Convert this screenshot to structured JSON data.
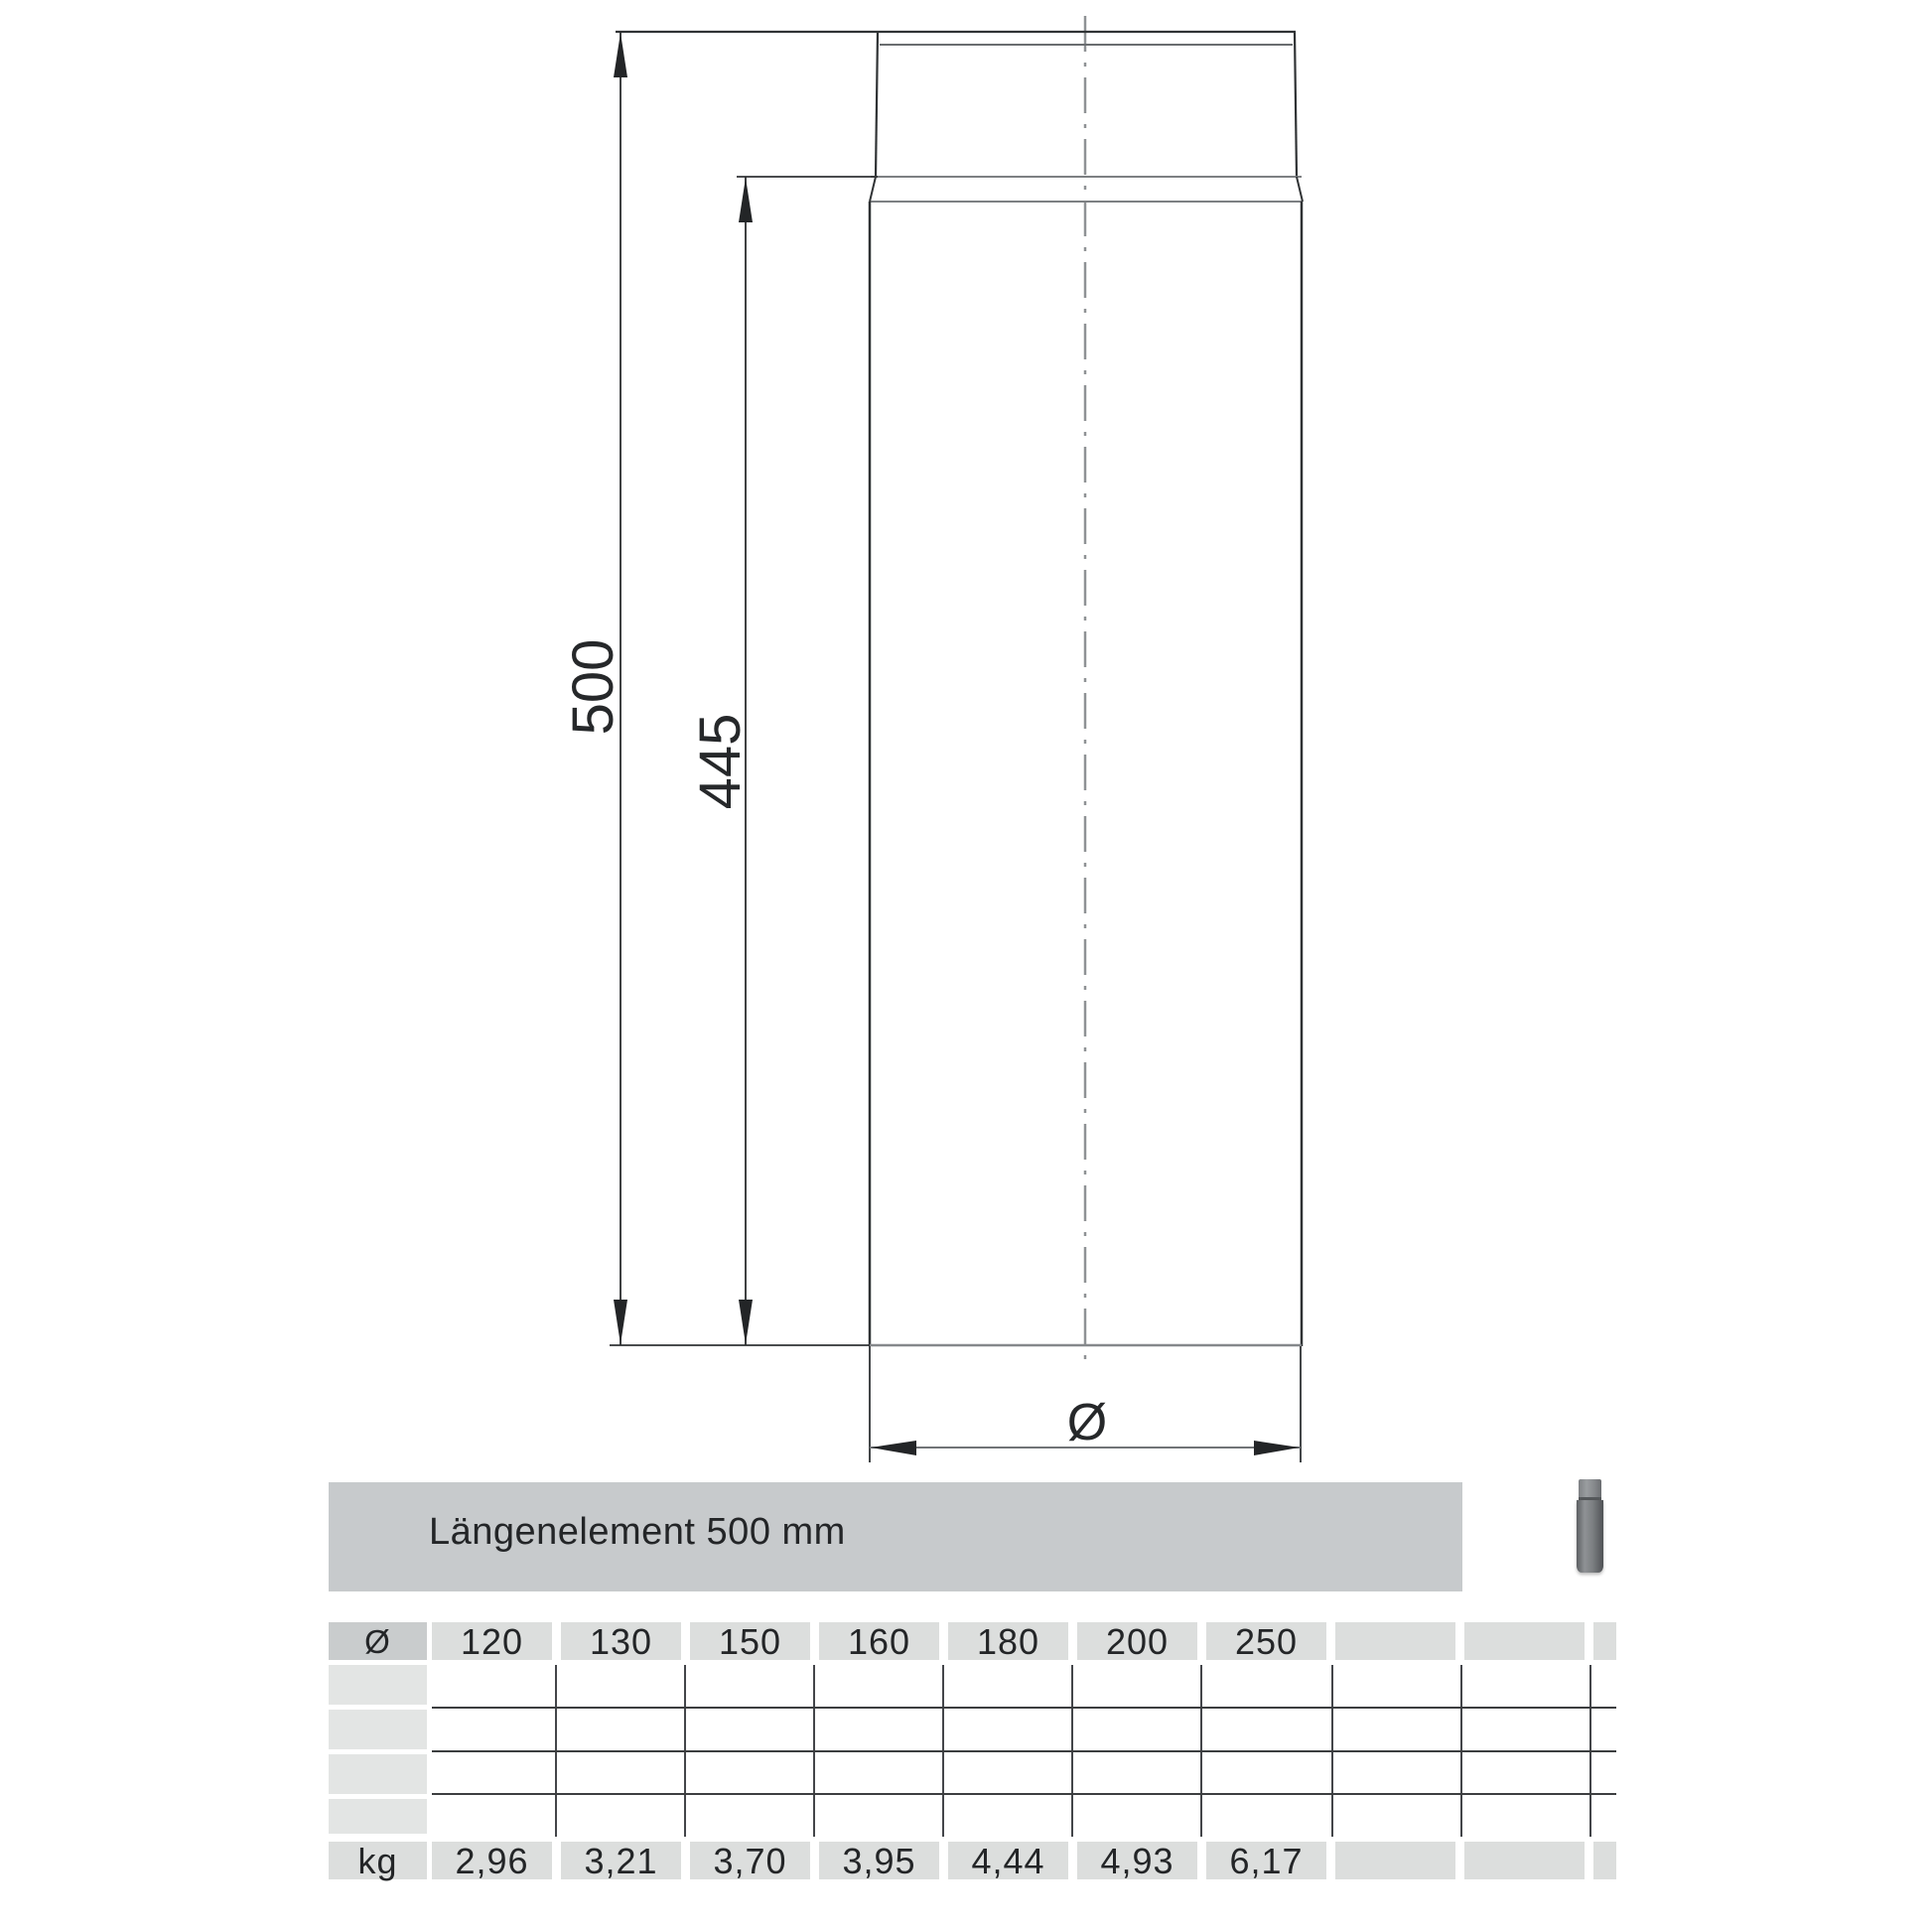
{
  "product": {
    "title": "Längenelement 500 mm"
  },
  "drawing": {
    "total_length_mm": "500",
    "body_length_mm": "445",
    "diameter_symbol": "Ø"
  },
  "table": {
    "corner_symbol": "Ø",
    "unit_label": "kg",
    "diameters": [
      "120",
      "130",
      "150",
      "160",
      "180",
      "200",
      "250"
    ],
    "weights": [
      "2,96",
      "3,21",
      "3,70",
      "3,95",
      "4,44",
      "4,93",
      "6,17"
    ],
    "empty_body_rows": 4
  },
  "colors": {
    "title_bar": "#c7cacc",
    "corner_cell": "#c9cccd",
    "header_cell": "#dcdedd",
    "row_label_cell": "#e3e5e4",
    "grid_line": "#3c3e40",
    "drawing_line": "#2f3234",
    "center_line": "#8f9295",
    "thumbnail_pipe": "#7c7f82"
  }
}
